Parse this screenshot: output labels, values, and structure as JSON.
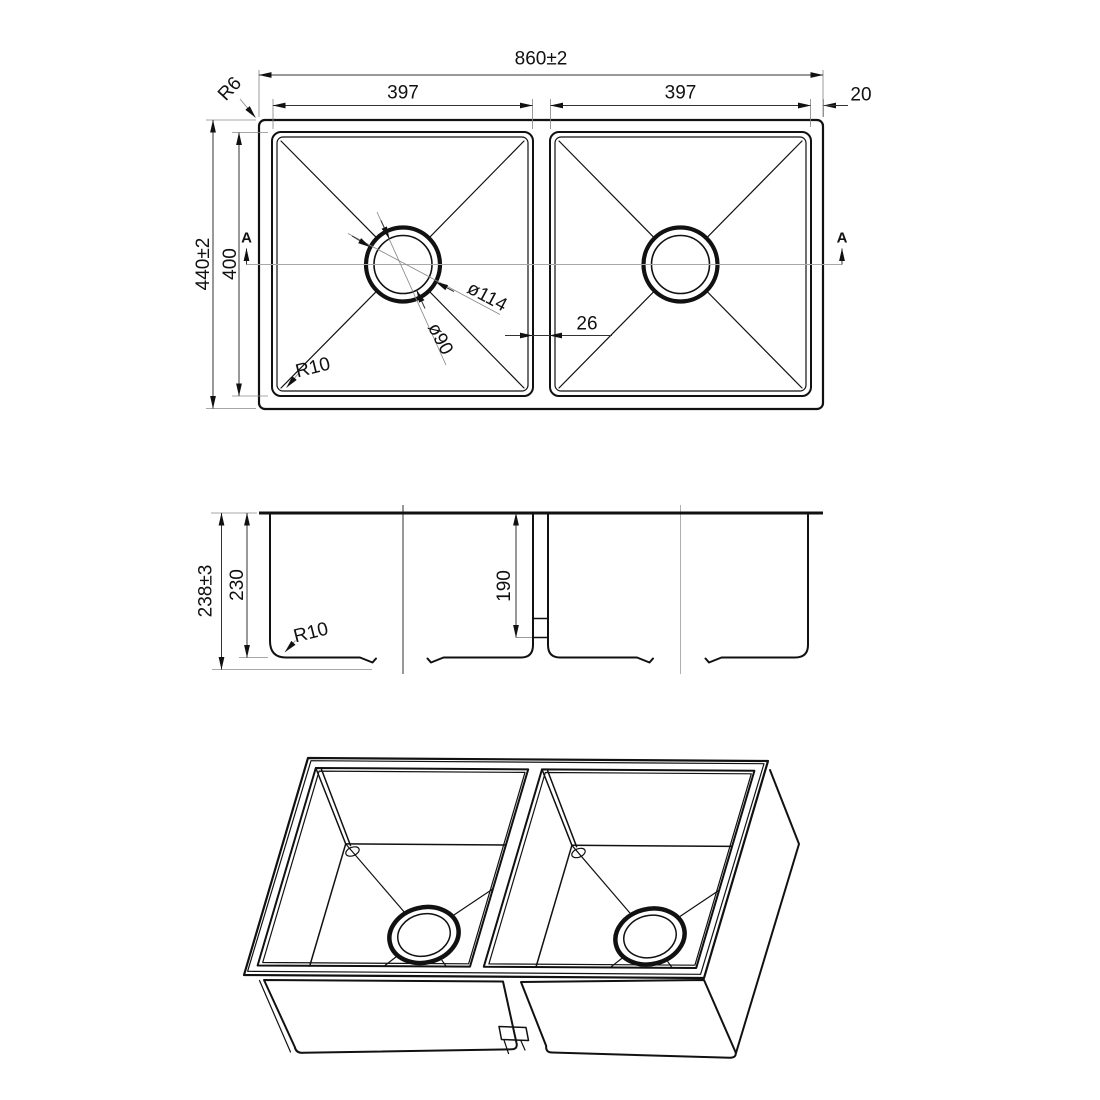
{
  "drawing": {
    "type": "sink-technical-drawing",
    "plan_view": {
      "overall_width": "860±2",
      "left_bowl_width": "397",
      "right_bowl_width": "397",
      "edge_width": "20",
      "overall_depth": "440±2",
      "bowl_depth": "400",
      "outer_corner_radius": "R6",
      "bowl_corner_radius": "R10",
      "drain_outer_dia": "ø114",
      "drain_inner_dia": "ø90",
      "divider_width": "26",
      "section_label_left": "A",
      "section_label_right": "A"
    },
    "section_view": {
      "overall_depth": "238±3",
      "bowl_depth": "230",
      "divider_depth": "190",
      "bottom_corner_radius": "R10"
    },
    "colors": {
      "line": "#111111",
      "dimension": "#333333",
      "extension": "#8a8a8a",
      "centerline": "#a8a8a8",
      "background": "#ffffff"
    }
  }
}
